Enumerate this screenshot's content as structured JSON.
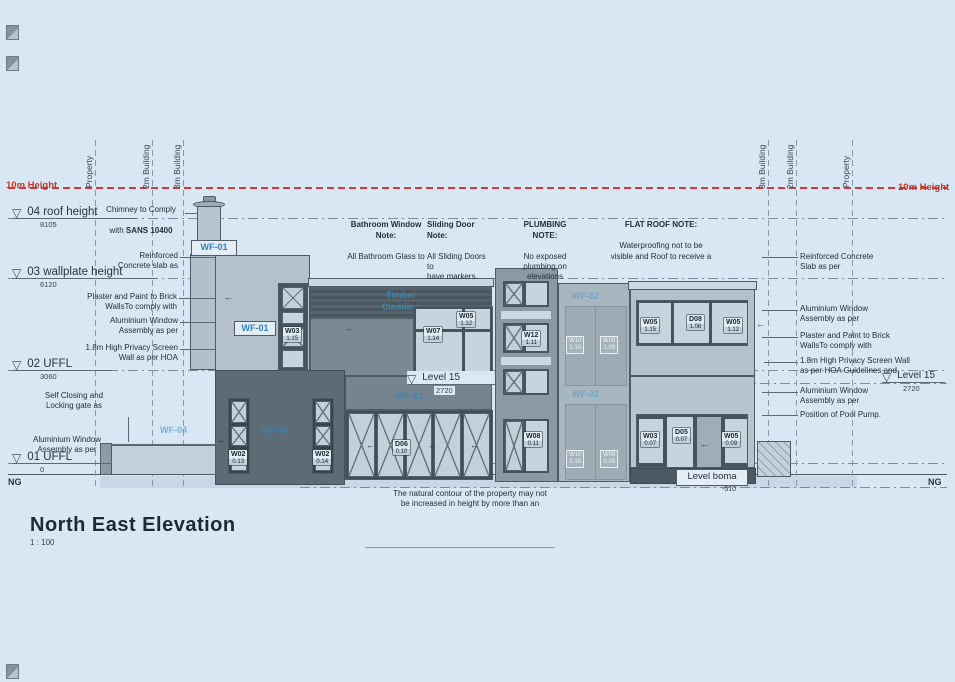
{
  "title": {
    "name": "North East Elevation",
    "scale": "1 : 100"
  },
  "height_line": {
    "left": "10m Height",
    "right": "10m Height"
  },
  "boundaries": {
    "l1": "Property",
    "l2": "2m Building",
    "l3": "3m Building",
    "r1": "3m Building",
    "r2": "2m Building",
    "r3": "Property"
  },
  "levels": {
    "roof": {
      "name": "04 roof height",
      "value": "8105"
    },
    "wallplate": {
      "name": "03 wallplate height",
      "value": "6120"
    },
    "uffl2": {
      "name": "02 UFFL",
      "value": "3060"
    },
    "uffl1": {
      "name": "01 UFFL",
      "value": "0"
    },
    "ng": "NG",
    "level15": {
      "name": "Level 15",
      "value": "2720"
    },
    "boma": {
      "name": "Level boma",
      "value": "-510"
    }
  },
  "notes": {
    "chimney": {
      "l1": "Chimney to Comply",
      "l2a": "with ",
      "l2b": "SANS 10400"
    },
    "left_reinforced": "Reinforced\nConcrete slab as",
    "left_plaster": "Plaster and Paint to Brick\nWallsTo comply with",
    "left_alu_window": "Aluminium Window\nAssembly as per",
    "left_privacy": "1.8m High Privacy Screen\nWall as per HOA",
    "left_gate": "Self Closing and\nLocking gate as",
    "left_alu_window2": "Aluminium Window\nAssembly as per",
    "bathroom": {
      "title": "Bathroom Window\nNote:",
      "body": "All Bathroom Glass to"
    },
    "sliding": {
      "title": "Sliding Door\nNote:",
      "body": "All Sliding Doors\nto\nhave markers."
    },
    "plumbing": {
      "title": "PLUMBING\nNOTE:",
      "body": "No exposed\nplumbing on\nelevations"
    },
    "flatroof": {
      "title": "FLAT ROOF NOTE:",
      "body": "Waterproofing not to be\nvisible and Roof to receive a"
    },
    "right_reinforced": "Reinforced Concrete\nSlab as per",
    "right_alu_window": "Aluminium Window\nAssembly as per",
    "right_plaster": "Plaster and Paint to Brick\nWallsTo comply with",
    "right_privacy": "1.8m High Privacy Screen Wall\nas per HOA Guidelines and",
    "right_alu_window2": "Aluminium Window\nAssembly as per",
    "pool_pump": "Position of Pool Pump.",
    "contour": "The natural contour of the property may not\nbe increased in height by more than an"
  },
  "frames": {
    "wf01_a": "WF-01",
    "wf01_b": "WF-01",
    "wf02_a": "WF-02",
    "wf02_b": "WF-02",
    "wf03_a": "WF-03",
    "wf03_b": "WF-03",
    "wf04": "WF-04",
    "cladding": "Timber\nCladding"
  },
  "tags": {
    "w03_tower": {
      "code": "W03",
      "num": "1.15"
    },
    "w05_top": {
      "code": "W05",
      "num": "1.12"
    },
    "w07": {
      "code": "W07",
      "num": "1.14"
    },
    "w12": {
      "code": "W12",
      "num": "1.11"
    },
    "w05_r1": {
      "code": "W05",
      "num": "1.15"
    },
    "d08": {
      "code": "D08",
      "num": "1.08"
    },
    "w05_r2": {
      "code": "W05",
      "num": "1.12"
    },
    "w02_a": {
      "code": "W02",
      "num": "0.13"
    },
    "w02_b": {
      "code": "W02",
      "num": "0.14"
    },
    "d06": {
      "code": "D06",
      "num": "0.10"
    },
    "w08": {
      "code": "W08",
      "num": "0.11"
    },
    "w03_low": {
      "code": "W03",
      "num": "0.07"
    },
    "d05": {
      "code": "D05",
      "num": "0.07"
    },
    "w05_low": {
      "code": "W05",
      "num": "0.09"
    },
    "wt_a": {
      "code": "W10",
      "num": "1.10"
    },
    "wt_b": {
      "code": "W09",
      "num": "1.09"
    },
    "wt_c": {
      "code": "W10",
      "num": "0.10"
    },
    "wt_d": {
      "code": "W09",
      "num": "0.09"
    }
  },
  "colors": {
    "sheet_background": "#d9e7f4",
    "height_limit_red": "#cf3a3a",
    "frame_label_blue": "#2f86c4",
    "wall_dark": "#5d6b74",
    "wall_light": "#b4c1ca"
  }
}
